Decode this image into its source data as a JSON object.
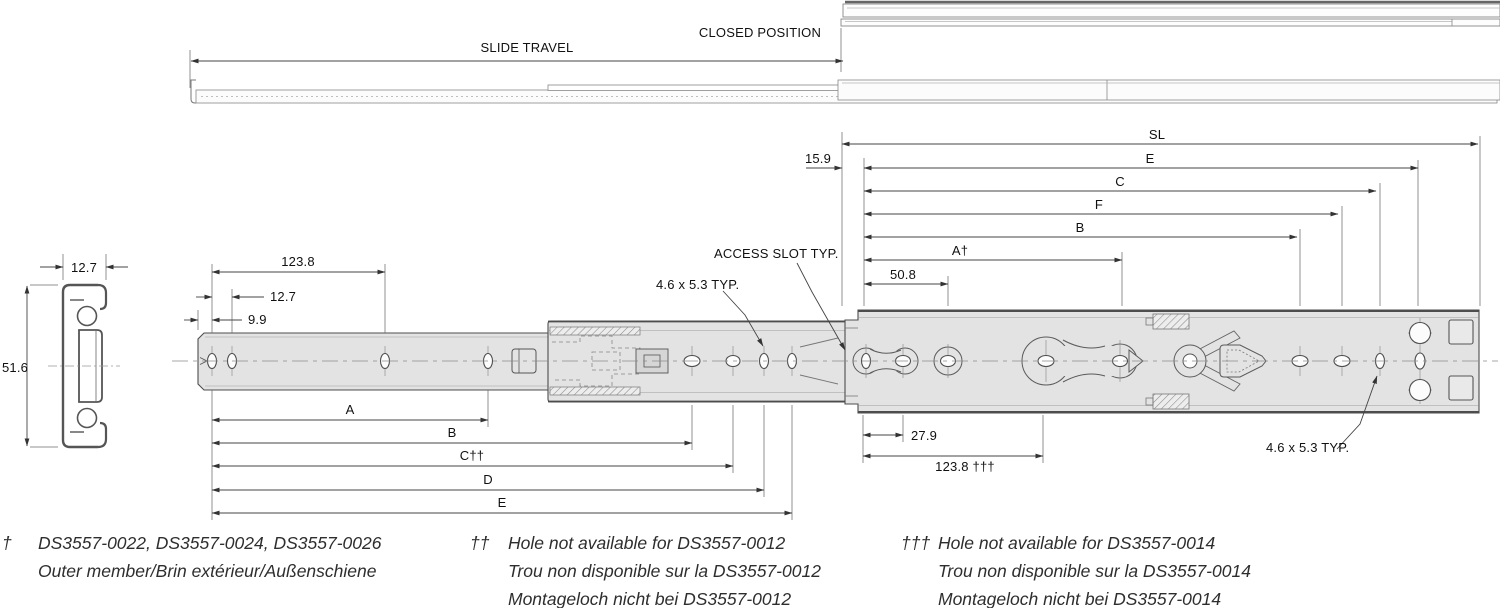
{
  "colors": {
    "member_fill": "#e3e3e3",
    "outline": "#4d4d4d",
    "dimension_line": "#444444",
    "background": "#ffffff"
  },
  "drawing": {
    "top_labels": {
      "slide_travel": "SLIDE TRAVEL",
      "closed_position": "CLOSED POSITION"
    },
    "section": {
      "width": "12.7",
      "height": "51.6"
    },
    "upper_dims": {
      "sl": "SL",
      "e": "E",
      "c": "C",
      "f": "F",
      "b": "B",
      "a_dagger": "A†",
      "len_50_8": "50.8",
      "len_15_9": "15.9"
    },
    "left_dims": {
      "len_123_8": "123.8",
      "len_12_7": "12.7",
      "len_9_9": "9.9"
    },
    "lower_dims": {
      "a": "A",
      "b": "B",
      "c_daggers": "C††",
      "d": "D",
      "e": "E",
      "len_27_9": "27.9",
      "len_123_8_daggers": "123.8 †††"
    },
    "callouts": {
      "access_slot": "ACCESS SLOT TYP.",
      "hole_size_mid": "4.6 x 5.3 TYP.",
      "hole_size_right": "4.6 x 5.3 TYP."
    }
  },
  "footnotes": [
    {
      "marker": "†",
      "lines": [
        "DS3557-0022, DS3557-0024, DS3557-0026",
        "Outer member/Brin extérieur/Außenschiene"
      ]
    },
    {
      "marker": "††",
      "lines": [
        "Hole not available for DS3557-0012",
        "Trou non disponible sur la DS3557-0012",
        "Montageloch nicht bei DS3557-0012"
      ]
    },
    {
      "marker": "†††",
      "lines": [
        "Hole not available for DS3557-0014",
        "Trou non disponible sur la DS3557-0014",
        "Montageloch nicht bei DS3557-0014"
      ]
    }
  ]
}
